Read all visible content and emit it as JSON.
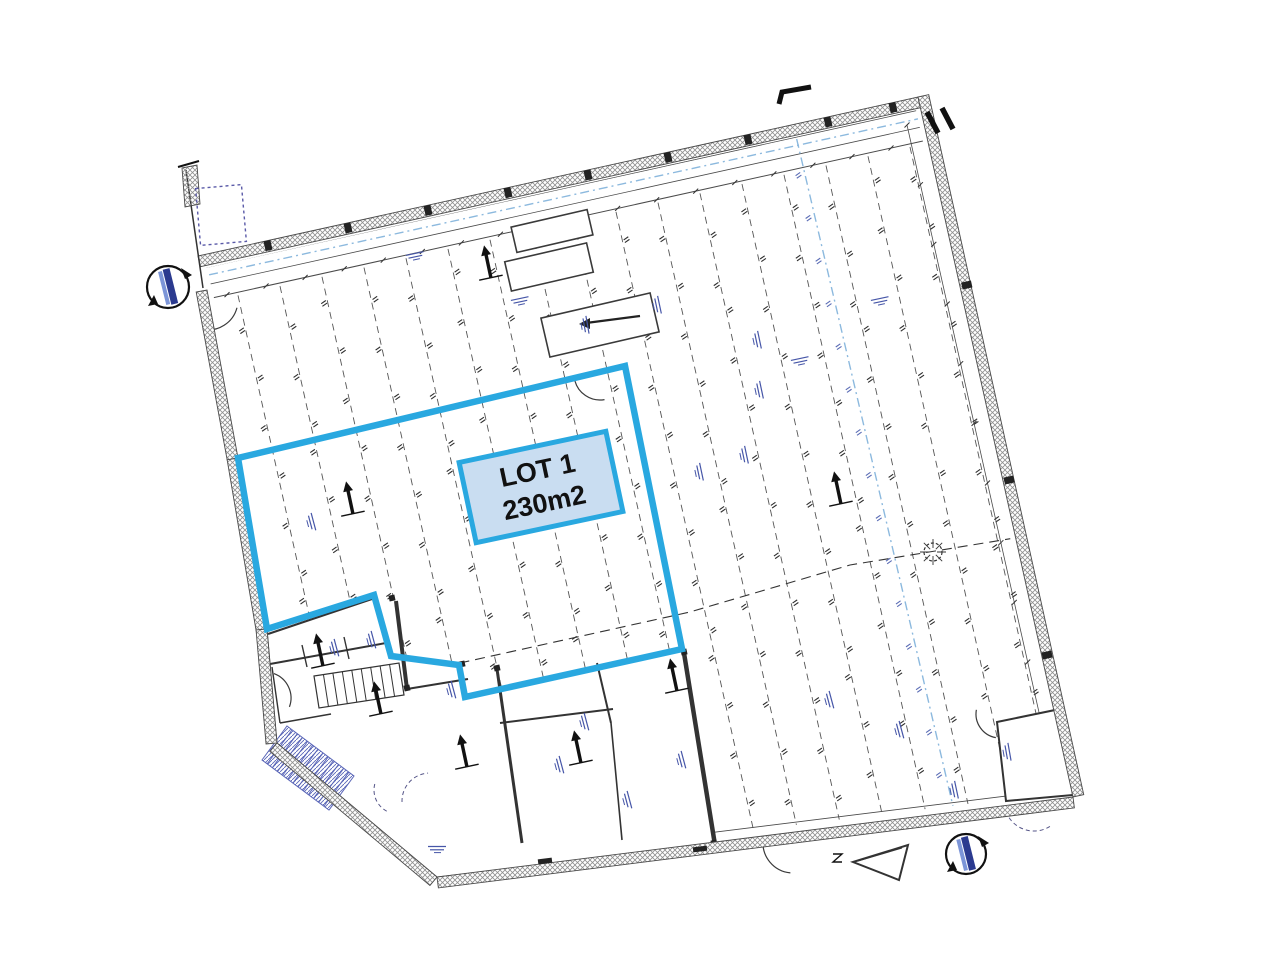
{
  "page": {
    "bg": "#ffffff",
    "width": 1280,
    "height": 961,
    "description": "Architectural floor plan, rotated ~12deg, with LOT 1 outlined in blue"
  },
  "lot": {
    "label_line1": "LOT 1",
    "label_line2": "230m2",
    "outline_color": "#29a8e0",
    "label_fill": "#c9ddf1",
    "label_text_color": "#111111",
    "outline_width": 6.5,
    "outline_points": [
      [
        625,
        366
      ],
      [
        238,
        458
      ],
      [
        267,
        629
      ],
      [
        374,
        595
      ],
      [
        391,
        656
      ],
      [
        459,
        665
      ],
      [
        465,
        697
      ],
      [
        682,
        649
      ]
    ],
    "label_box": {
      "cx": 541,
      "cy": 487,
      "w": 150,
      "h": 82,
      "rot": -12,
      "border_width": 5
    }
  },
  "drawing": {
    "ink": "#3a3a3a",
    "wall_edge": "#4a4a4a",
    "hatch_color": "#8f8f8f",
    "navy": "#4656a8",
    "skyblue": "#8cb9de",
    "building": {
      "top_wall": [
        [
          198,
          256
        ],
        [
          918,
          97
        ]
      ],
      "right_wall": [
        [
          918,
          97
        ],
        [
          1073,
          797
        ]
      ],
      "bottom_wall": [
        [
          1073,
          797
        ],
        [
          437,
          877
        ]
      ],
      "chamfer": [
        [
          437,
          877
        ],
        [
          277,
          743
        ]
      ],
      "left_wall": [
        [
          207,
          290
        ],
        [
          238,
          458
        ],
        [
          267,
          629
        ],
        [
          277,
          743
        ]
      ],
      "wall_thickness": 11,
      "interior_clip": [
        [
          206,
          268
        ],
        [
          916,
          110
        ],
        [
          1066,
          792
        ],
        [
          441,
          868
        ],
        [
          283,
          741
        ],
        [
          213,
          292
        ]
      ]
    },
    "joists": {
      "count": 17,
      "x_start": 228,
      "x_step": 42,
      "dir": [
        0.2171,
        0.9761
      ],
      "top_offset": 46,
      "dash": "7 5",
      "tick_spacing": 48
    },
    "inner_line_offsets": [
      13,
      30,
      44
    ],
    "blocks": {
      "bottom_left": [
        [
          267,
          629
        ],
        [
          374,
          595
        ],
        [
          391,
          656
        ],
        [
          459,
          665
        ],
        [
          465,
          697
        ],
        [
          682,
          649
        ],
        [
          716,
          846
        ],
        [
          437,
          877
        ],
        [
          277,
          743
        ]
      ],
      "small_room": [
        [
          997,
          722
        ],
        [
          1060,
          709
        ],
        [
          1073,
          795
        ],
        [
          1006,
          801
        ]
      ]
    },
    "interior_walls": [
      [
        268,
        634,
        372,
        599,
        2
      ],
      [
        270,
        664,
        386,
        643,
        2
      ],
      [
        302,
        645,
        307,
        667,
        1.4
      ],
      [
        344,
        637,
        349,
        659,
        1.4
      ],
      [
        396,
        601,
        407,
        689,
        4
      ],
      [
        407,
        689,
        468,
        679,
        2
      ],
      [
        497,
        669,
        522,
        843,
        3
      ],
      [
        500,
        723,
        613,
        709,
        2
      ],
      [
        597,
        663,
        611,
        723,
        2
      ],
      [
        684,
        653,
        715,
        845,
        4.5
      ],
      [
        272,
        667,
        280,
        723,
        1.4
      ],
      [
        280,
        723,
        331,
        714,
        1.4
      ],
      [
        611,
        723,
        622,
        840,
        1.6
      ]
    ],
    "stair_black": {
      "quad": [
        [
          314,
          676
        ],
        [
          399,
          663
        ],
        [
          404,
          695
        ],
        [
          319,
          708
        ]
      ],
      "treads": 9
    },
    "stair_blue": {
      "origin": [
        287,
        726
      ],
      "v": [
        67,
        50
      ],
      "w": [
        -25,
        34
      ],
      "treads": 13
    },
    "arcs": [
      [
        208,
        300,
        30,
        15,
        100
      ],
      [
        265,
        698,
        26,
        -70,
        20
      ],
      [
        793,
        843,
        30,
        95,
        185
      ],
      [
        1000,
        714,
        24,
        100,
        190
      ],
      [
        600,
        374,
        26,
        80,
        168
      ]
    ],
    "dashed_arcs": [
      [
        430,
        801,
        28,
        178,
        266
      ],
      [
        398,
        790,
        24,
        118,
        198
      ],
      [
        1034,
        801,
        30,
        58,
        148
      ]
    ],
    "markers": [
      [
        350,
        500
      ],
      [
        488,
        264
      ],
      [
        838,
        490
      ],
      [
        378,
        700
      ],
      [
        464,
        753
      ],
      [
        578,
        749
      ],
      [
        674,
        677
      ],
      [
        320,
        652
      ]
    ],
    "smudges": [
      [
        335,
        648,
        75
      ],
      [
        372,
        640,
        75
      ],
      [
        452,
        690,
        75
      ],
      [
        585,
        722,
        75
      ],
      [
        682,
        760,
        75
      ],
      [
        560,
        765,
        75
      ],
      [
        628,
        800,
        75
      ],
      [
        437,
        848,
        0
      ],
      [
        745,
        455,
        78
      ],
      [
        700,
        472,
        78
      ],
      [
        586,
        325,
        80
      ],
      [
        880,
        300,
        -12
      ],
      [
        520,
        300,
        -12
      ],
      [
        415,
        255,
        -12
      ],
      [
        1008,
        752,
        80
      ],
      [
        758,
        340,
        78
      ],
      [
        830,
        700,
        75
      ],
      [
        900,
        730,
        75
      ],
      [
        955,
        790,
        78
      ],
      [
        312,
        522,
        75
      ],
      [
        760,
        390,
        78
      ],
      [
        800,
        360,
        -12
      ],
      [
        658,
        305,
        78
      ]
    ],
    "rects": [
      {
        "cx": 552,
        "cy": 231,
        "w": 78,
        "h": 26,
        "rot": -13
      },
      {
        "cx": 549,
        "cy": 267,
        "w": 84,
        "h": 30,
        "rot": -13
      },
      {
        "cx": 600,
        "cy": 325,
        "w": 112,
        "h": 40,
        "rot": -13
      }
    ],
    "room_arrow": [
      640,
      316,
      586,
      323
    ],
    "dotted_rect": {
      "cx": 221,
      "cy": 215,
      "w": 46,
      "h": 57,
      "rot": -5
    },
    "section_lines": [
      [
        172,
        283,
        940,
        114
      ],
      [
        788,
        102,
        960,
        836
      ]
    ],
    "dashed_polyline": [
      [
        397,
        677
      ],
      [
        690,
        612
      ],
      [
        850,
        565
      ],
      [
        1045,
        533
      ]
    ],
    "star_circle": {
      "cx": 933,
      "cy": 552,
      "r": 9
    },
    "section_circles": [
      {
        "cx": 168,
        "cy": 287,
        "r": 21
      },
      {
        "cx": 966,
        "cy": 854,
        "r": 20
      }
    ],
    "flag": [
      [
        779,
        104
      ],
      [
        782,
        92
      ],
      [
        811,
        87
      ]
    ],
    "ii_marks": [
      [
        927,
        112,
        938,
        133
      ],
      [
        942,
        108,
        953,
        129
      ]
    ],
    "triangle": [
      [
        853,
        862
      ],
      [
        908,
        845
      ],
      [
        899,
        880
      ]
    ],
    "z_mark": [
      838,
      858
    ],
    "stub": {
      "line": [
        186,
        170,
        203,
        288
      ],
      "hatch": [
        [
          182,
          168
        ],
        [
          197,
          165
        ],
        [
          200,
          204
        ],
        [
          185,
          207
        ]
      ],
      "tick": [
        178,
        167,
        199,
        161
      ]
    },
    "thresholds": [
      [
        545,
        861
      ],
      [
        700,
        849
      ]
    ],
    "columns": {
      "top_xs": [
        268,
        348,
        428,
        508,
        588,
        668,
        748,
        828,
        893
      ],
      "right_ys": [
        285,
        480,
        655
      ]
    }
  }
}
